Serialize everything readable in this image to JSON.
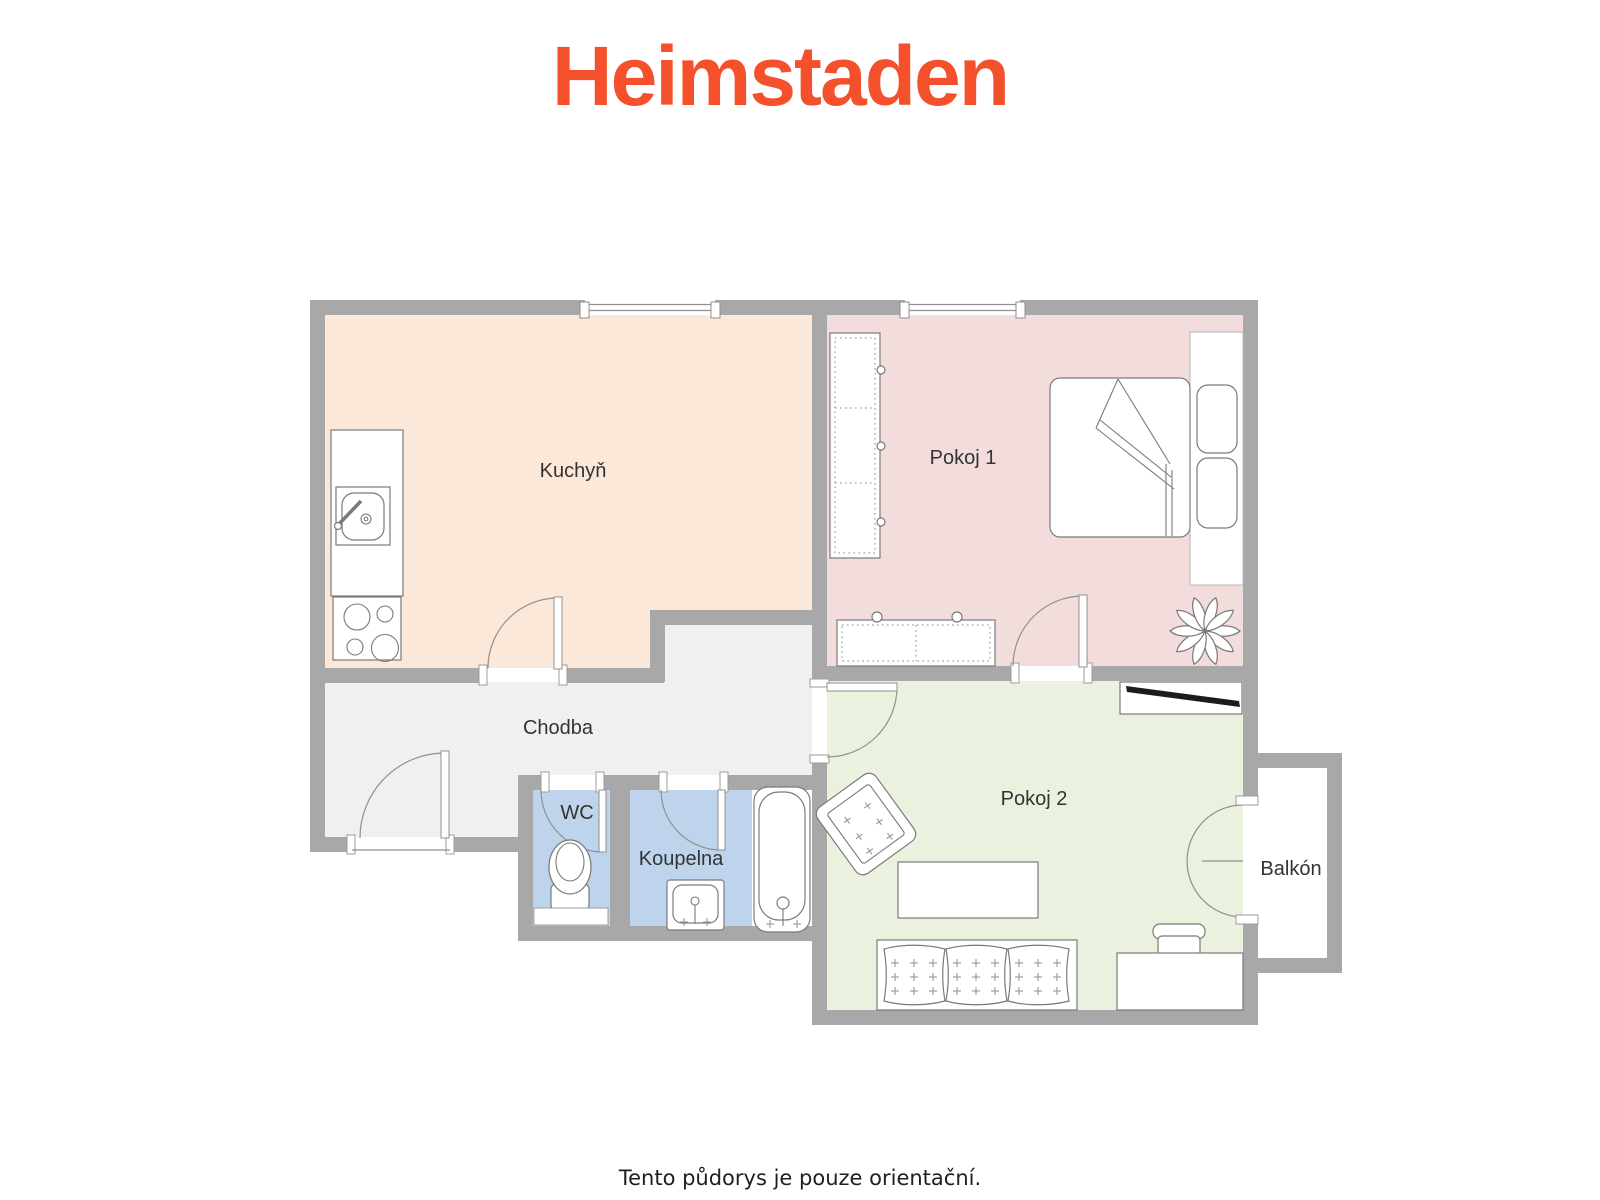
{
  "logo": {
    "text": "Heimstaden",
    "color": "#F3502B"
  },
  "floorplan": {
    "wall_color": "#A8A8A8",
    "label_color": "#333333",
    "rooms": {
      "kuchyn": {
        "label": "Kuchyň",
        "fill": "#FBE8D9"
      },
      "pokoj1": {
        "label": "Pokoj 1",
        "fill": "#F2DDDC"
      },
      "chodba": {
        "label": "Chodba",
        "fill": "#F0F0F0"
      },
      "wc": {
        "label": "WC",
        "fill": "#BED4EC"
      },
      "koupelna": {
        "label": "Koupelna",
        "fill": "#BED4EC"
      },
      "pokoj2": {
        "label": "Pokoj 2",
        "fill": "#EBF1DF"
      },
      "balkon": {
        "label": "Balkón",
        "fill": "#FFFFFF"
      }
    },
    "furniture": {
      "kuchyn": [
        "counter",
        "sink",
        "stove"
      ],
      "pokoj1": [
        "wardrobe",
        "bed",
        "pillows",
        "dresser",
        "plant"
      ],
      "wc": [
        "toilet"
      ],
      "koupelna": [
        "washbasin",
        "bathtub"
      ],
      "pokoj2": [
        "tv-sideboard",
        "tv",
        "armchair",
        "coffee-table",
        "sofa",
        "desk",
        "chair"
      ]
    }
  },
  "footer": {
    "text": "Tento půdorys je pouze orientační.",
    "color": "#1F1F1F"
  }
}
